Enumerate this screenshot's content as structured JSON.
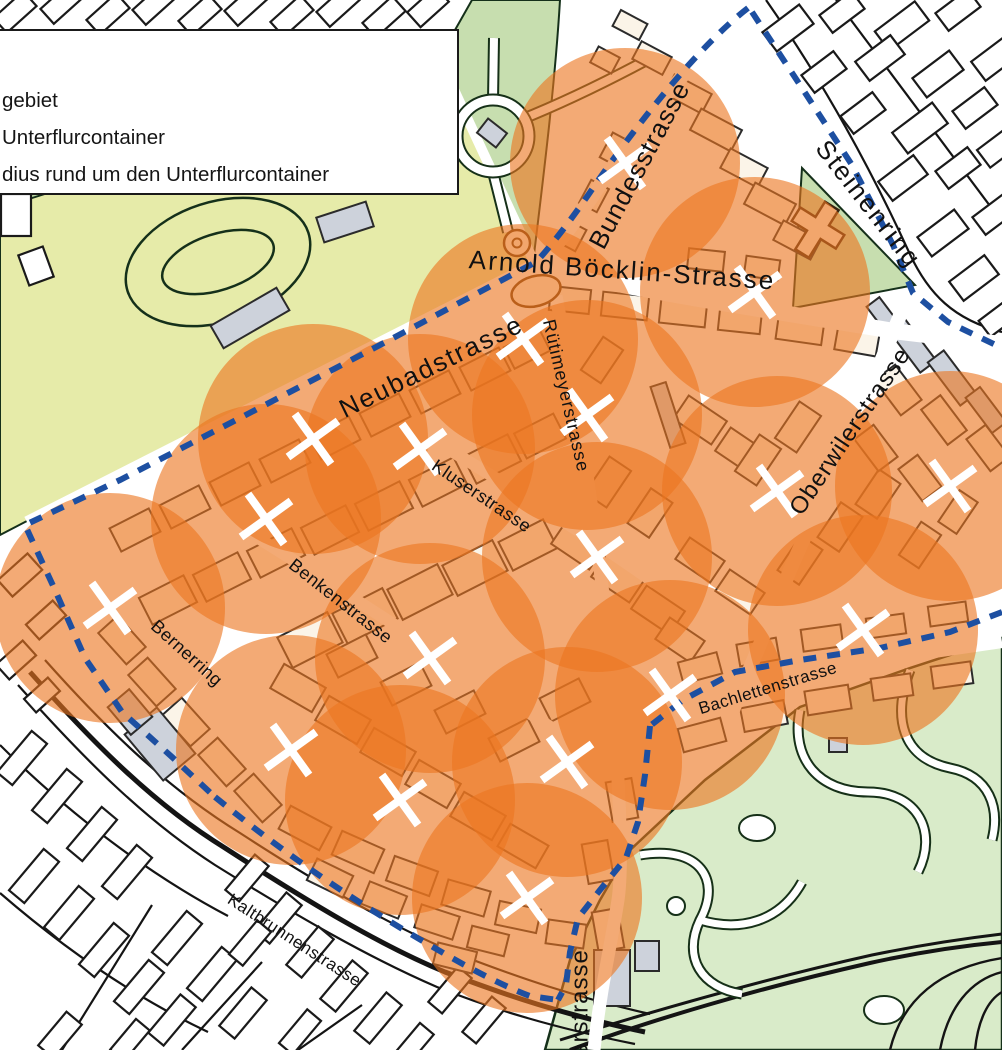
{
  "legend": {
    "row1": "gebiet",
    "row2": "Unterflurcontainer",
    "row3": "dius rund um den Unterflurcontainer"
  },
  "map": {
    "colors": {
      "circle_fill": "#EC7620",
      "circle_opacity": 0.62,
      "boundary_dash": "#1D4FA1",
      "cross": "#FFFFFF",
      "field_green": "#E6EBA9",
      "band_green": "#BCD6A2",
      "park_north_green": "#C7DEAF",
      "park_south_green": "#D9EBC9",
      "building_grey": "#CDD2DB",
      "building_cream": "#FBF4E8",
      "building_white": "#FFFFFF",
      "outline": "#1a1a1a",
      "label_color": "#111111"
    },
    "street_labels": [
      {
        "text": "Bundesstrasse",
        "x": 641,
        "y": 166,
        "rotate": -62,
        "size": 26,
        "spacing": 1
      },
      {
        "text": "Arnold Böcklin-Strasse",
        "x": 622,
        "y": 272,
        "rotate": 4,
        "size": 26,
        "spacing": 2
      },
      {
        "text": "Steinenring",
        "x": 867,
        "y": 205,
        "rotate": 52,
        "size": 26,
        "spacing": 2
      },
      {
        "text": "Neubadstrasse",
        "x": 432,
        "y": 368,
        "rotate": -26,
        "size": 26,
        "spacing": 2
      },
      {
        "text": "Rütimeyerstrasse",
        "x": 565,
        "y": 396,
        "rotate": 77,
        "size": 18,
        "spacing": 1
      },
      {
        "text": "Kluserstrasse",
        "x": 481,
        "y": 497,
        "rotate": 34,
        "size": 18,
        "spacing": 0.5
      },
      {
        "text": "Benkenstrasse",
        "x": 340,
        "y": 602,
        "rotate": 38,
        "size": 18,
        "spacing": 0.5
      },
      {
        "text": "Bernerring",
        "x": 186,
        "y": 654,
        "rotate": 42,
        "size": 18,
        "spacing": 0.5
      },
      {
        "text": "Oberwilerstrasse",
        "x": 851,
        "y": 432,
        "rotate": -56,
        "size": 24,
        "spacing": 1
      },
      {
        "text": "Bachlettenstrasse",
        "x": 768,
        "y": 689,
        "rotate": -17,
        "size": 17,
        "spacing": 0.5
      },
      {
        "text": "Kaltbrunnenstrasse",
        "x": 294,
        "y": 941,
        "rotate": 33,
        "size": 17,
        "spacing": 0.5
      },
      {
        "text": "erstrasse",
        "x": 581,
        "y": 1003,
        "rotate": -90,
        "size": 24,
        "spacing": 1
      }
    ],
    "containers": {
      "marker": "white-cross",
      "radius_px": 115,
      "positions": [
        [
          625,
          163
        ],
        [
          755,
          292
        ],
        [
          523,
          339
        ],
        [
          587,
          415
        ],
        [
          313,
          439
        ],
        [
          420,
          449
        ],
        [
          266,
          519
        ],
        [
          597,
          557
        ],
        [
          110,
          608
        ],
        [
          430,
          658
        ],
        [
          777,
          491
        ],
        [
          950,
          486
        ],
        [
          863,
          630
        ],
        [
          670,
          695
        ],
        [
          291,
          750
        ],
        [
          567,
          762
        ],
        [
          400,
          800
        ],
        [
          527,
          898
        ]
      ]
    },
    "blocks": {
      "outside": [
        [
          15,
          12,
          40,
          20,
          -42
        ],
        [
          62,
          3,
          40,
          20,
          -42
        ],
        [
          108,
          14,
          40,
          20,
          -42
        ],
        [
          154,
          4,
          40,
          20,
          -42
        ],
        [
          200,
          15,
          40,
          20,
          -42
        ],
        [
          246,
          5,
          40,
          20,
          -42
        ],
        [
          292,
          16,
          40,
          20,
          -42
        ],
        [
          338,
          6,
          40,
          20,
          -42
        ],
        [
          384,
          17,
          40,
          20,
          -42
        ],
        [
          428,
          7,
          38,
          20,
          -42
        ],
        [
          16,
          215,
          30,
          42,
          0
        ],
        [
          36,
          266,
          26,
          32,
          -20
        ],
        [
          788,
          28,
          46,
          24,
          -37
        ],
        [
          842,
          12,
          40,
          22,
          -37
        ],
        [
          902,
          26,
          50,
          24,
          -37
        ],
        [
          958,
          10,
          40,
          22,
          -37
        ],
        [
          996,
          58,
          44,
          24,
          -37
        ],
        [
          824,
          72,
          40,
          22,
          -37
        ],
        [
          880,
          58,
          44,
          24,
          -37
        ],
        [
          938,
          74,
          46,
          24,
          -37
        ],
        [
          863,
          113,
          40,
          22,
          -37
        ],
        [
          920,
          128,
          50,
          26,
          -37
        ],
        [
          975,
          108,
          40,
          22,
          -37
        ],
        [
          903,
          178,
          44,
          24,
          -37
        ],
        [
          958,
          168,
          40,
          22,
          -37
        ],
        [
          998,
          148,
          36,
          22,
          -37
        ],
        [
          943,
          233,
          46,
          24,
          -37
        ],
        [
          995,
          214,
          40,
          22,
          -37
        ],
        [
          974,
          278,
          44,
          24,
          -37
        ],
        [
          999,
          318,
          36,
          20,
          -37
        ],
        [
          20,
          575,
          40,
          22,
          -42
        ],
        [
          46,
          620,
          36,
          20,
          -42
        ],
        [
          16,
          660,
          36,
          20,
          -42
        ],
        [
          42,
          695,
          32,
          18,
          -42
        ],
        [
          22,
          758,
          20,
          54,
          40
        ],
        [
          57,
          796,
          20,
          54,
          40
        ],
        [
          92,
          834,
          20,
          54,
          40
        ],
        [
          127,
          872,
          20,
          54,
          40
        ],
        [
          34,
          876,
          20,
          54,
          40
        ],
        [
          69,
          913,
          20,
          54,
          40
        ],
        [
          104,
          950,
          20,
          54,
          40
        ],
        [
          139,
          987,
          20,
          54,
          40
        ],
        [
          177,
          938,
          20,
          54,
          40
        ],
        [
          212,
          974,
          20,
          54,
          40
        ],
        [
          172,
          1020,
          20,
          50,
          40
        ],
        [
          243,
          1013,
          20,
          50,
          40
        ],
        [
          278,
          918,
          20,
          50,
          40
        ],
        [
          247,
          878,
          18,
          46,
          40
        ],
        [
          310,
          952,
          20,
          50,
          40
        ],
        [
          344,
          986,
          20,
          50,
          40
        ],
        [
          300,
          1032,
          18,
          44,
          40
        ],
        [
          378,
          1018,
          20,
          50,
          40
        ],
        [
          414,
          1044,
          18,
          40,
          40
        ],
        [
          450,
          990,
          18,
          46,
          40
        ],
        [
          484,
          1020,
          18,
          46,
          40
        ],
        [
          250,
          943,
          18,
          44,
          40
        ],
        [
          60,
          1035,
          20,
          44,
          40
        ],
        [
          130,
          1040,
          18,
          40,
          40
        ]
      ],
      "inside": [
        [
          652,
          58,
          34,
          20,
          28
        ],
        [
          688,
          94,
          42,
          22,
          28
        ],
        [
          716,
          130,
          46,
          24,
          28
        ],
        [
          744,
          168,
          42,
          22,
          28
        ],
        [
          770,
          204,
          46,
          24,
          28
        ],
        [
          797,
          240,
          42,
          22,
          28
        ],
        [
          616,
          150,
          22,
          28,
          28
        ],
        [
          594,
          196,
          20,
          26,
          28
        ],
        [
          572,
          236,
          20,
          24,
          28
        ],
        [
          630,
          25,
          30,
          18,
          28
        ],
        [
          605,
          60,
          24,
          18,
          28
        ],
        [
          570,
          300,
          40,
          24,
          6
        ],
        [
          625,
          306,
          46,
          24,
          6
        ],
        [
          683,
          313,
          46,
          24,
          6
        ],
        [
          740,
          320,
          42,
          24,
          6
        ],
        [
          800,
          330,
          46,
          24,
          8
        ],
        [
          857,
          341,
          42,
          24,
          10
        ],
        [
          706,
          260,
          36,
          20,
          6
        ],
        [
          762,
          268,
          34,
          20,
          8
        ],
        [
          135,
          530,
          44,
          26,
          -27
        ],
        [
          185,
          507,
          44,
          26,
          -27
        ],
        [
          235,
          484,
          44,
          26,
          -27
        ],
        [
          285,
          461,
          44,
          26,
          -27
        ],
        [
          335,
          438,
          44,
          26,
          -27
        ],
        [
          385,
          415,
          44,
          26,
          -27
        ],
        [
          435,
          392,
          44,
          26,
          -27
        ],
        [
          485,
          369,
          44,
          26,
          -27
        ],
        [
          527,
          349,
          40,
          24,
          -27
        ],
        [
          168,
          600,
          50,
          30,
          -27
        ],
        [
          222,
          577,
          50,
          30,
          -27
        ],
        [
          276,
          553,
          50,
          30,
          -27
        ],
        [
          330,
          530,
          50,
          30,
          -27
        ],
        [
          384,
          506,
          50,
          30,
          -27
        ],
        [
          438,
          482,
          50,
          30,
          -27
        ],
        [
          492,
          459,
          50,
          30,
          -27
        ],
        [
          540,
          436,
          44,
          28,
          -27
        ],
        [
          310,
          640,
          56,
          34,
          -27
        ],
        [
          365,
          616,
          56,
          34,
          -27
        ],
        [
          420,
          592,
          56,
          34,
          -27
        ],
        [
          475,
          568,
          56,
          34,
          -27
        ],
        [
          528,
          545,
          50,
          32,
          -27
        ],
        [
          122,
          640,
          42,
          26,
          48
        ],
        [
          152,
          682,
          42,
          26,
          48
        ],
        [
          186,
          722,
          42,
          26,
          48
        ],
        [
          222,
          762,
          42,
          26,
          48
        ],
        [
          258,
          798,
          42,
          26,
          48
        ],
        [
          298,
          688,
          48,
          28,
          30
        ],
        [
          343,
          720,
          48,
          28,
          30
        ],
        [
          388,
          752,
          48,
          28,
          30
        ],
        [
          433,
          784,
          48,
          28,
          30
        ],
        [
          478,
          816,
          48,
          28,
          30
        ],
        [
          523,
          846,
          44,
          26,
          30
        ],
        [
          352,
          656,
          44,
          26,
          -27
        ],
        [
          406,
          684,
          44,
          26,
          -27
        ],
        [
          460,
          712,
          44,
          26,
          -27
        ],
        [
          514,
          740,
          44,
          26,
          -27
        ],
        [
          565,
          700,
          44,
          26,
          -27
        ],
        [
          305,
          828,
          46,
          26,
          28
        ],
        [
          358,
          852,
          46,
          26,
          24
        ],
        [
          412,
          876,
          46,
          26,
          20
        ],
        [
          466,
          898,
          44,
          26,
          16
        ],
        [
          518,
          917,
          42,
          24,
          12
        ],
        [
          566,
          934,
          38,
          24,
          8
        ],
        [
          330,
          878,
          40,
          24,
          26
        ],
        [
          384,
          900,
          40,
          24,
          22
        ],
        [
          437,
          922,
          40,
          24,
          18
        ],
        [
          488,
          941,
          38,
          22,
          14
        ],
        [
          455,
          958,
          40,
          22,
          14
        ],
        [
          598,
          862,
          40,
          26,
          80
        ],
        [
          622,
          800,
          40,
          26,
          80
        ],
        [
          608,
          930,
          40,
          26,
          80
        ],
        [
          578,
          545,
          46,
          28,
          34
        ],
        [
          618,
          578,
          46,
          28,
          34
        ],
        [
          658,
          610,
          46,
          28,
          34
        ],
        [
          608,
          482,
          44,
          26,
          -56
        ],
        [
          650,
          513,
          42,
          26,
          -56
        ],
        [
          602,
          360,
          40,
          24,
          -56
        ],
        [
          700,
          420,
          46,
          28,
          34
        ],
        [
          742,
          452,
          46,
          28,
          34
        ],
        [
          700,
          560,
          42,
          26,
          34
        ],
        [
          740,
          592,
          42,
          26,
          34
        ],
        [
          680,
          640,
          42,
          26,
          34
        ],
        [
          758,
          460,
          44,
          26,
          -56
        ],
        [
          798,
          427,
          44,
          26,
          -56
        ],
        [
          800,
          560,
          42,
          26,
          -56
        ],
        [
          840,
          527,
          42,
          26,
          -56
        ],
        [
          878,
          494,
          42,
          26,
          -56
        ],
        [
          898,
          390,
          44,
          26,
          53
        ],
        [
          944,
          420,
          44,
          24,
          53
        ],
        [
          988,
          448,
          40,
          24,
          53
        ],
        [
          876,
          448,
          40,
          24,
          53
        ],
        [
          920,
          478,
          40,
          24,
          53
        ],
        [
          920,
          545,
          40,
          24,
          -56
        ],
        [
          958,
          512,
          38,
          22,
          -56
        ],
        [
          700,
          668,
          40,
          22,
          -15
        ],
        [
          758,
          652,
          40,
          22,
          -10
        ],
        [
          822,
          638,
          40,
          22,
          -8
        ],
        [
          886,
          626,
          38,
          20,
          -8
        ],
        [
          948,
          614,
          38,
          20,
          -8
        ],
        [
          702,
          735,
          44,
          24,
          -15
        ],
        [
          764,
          716,
          44,
          24,
          -11
        ],
        [
          828,
          700,
          44,
          24,
          -9
        ],
        [
          892,
          687,
          40,
          22,
          -8
        ],
        [
          952,
          675,
          40,
          22,
          -8
        ]
      ],
      "grey": [
        [
          912,
          345,
          54,
          20,
          53
        ],
        [
          952,
          378,
          54,
          20,
          53
        ],
        [
          986,
          410,
          44,
          18,
          53
        ],
        [
          885,
          318,
          40,
          16,
          53
        ],
        [
          668,
          415,
          16,
          64,
          -18
        ],
        [
          612,
          978,
          36,
          56,
          0
        ],
        [
          647,
          956,
          24,
          30,
          0
        ],
        [
          160,
          744,
          42,
          60,
          -40
        ],
        [
          130,
          712,
          28,
          36,
          -40
        ],
        [
          250,
          318,
          76,
          26,
          -30
        ],
        [
          345,
          222,
          52,
          26,
          -18
        ],
        [
          398,
          99,
          32,
          22,
          -40
        ],
        [
          492,
          133,
          24,
          18,
          38
        ],
        [
          838,
          745,
          18,
          14,
          0
        ]
      ]
    }
  }
}
